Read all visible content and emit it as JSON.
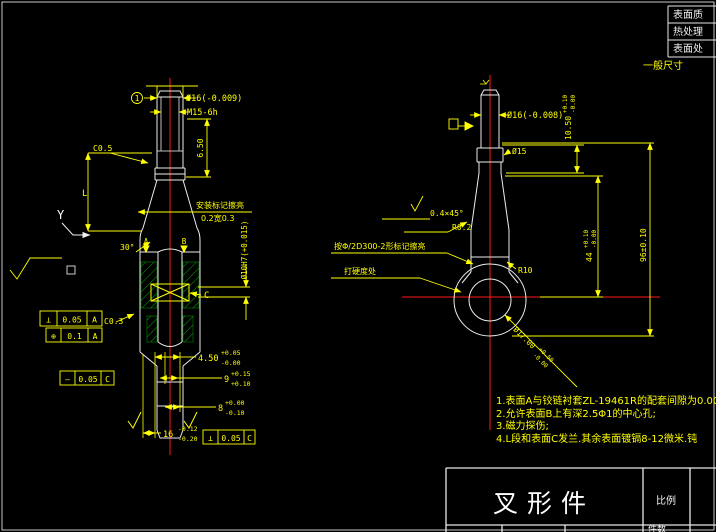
{
  "window": {
    "background": "#000000"
  },
  "colors": {
    "outline": "#f0f0f0",
    "dimension": "#ffff00",
    "centerline": "#ff0000",
    "hatch": "#00a300"
  },
  "info_table": {
    "rows": [
      "表面质",
      "热处理",
      "表面处"
    ]
  },
  "general_note": "一般尺寸",
  "notes": {
    "items": [
      "1.表面A与铰链衬套ZL-19461R的配套间隙为0.00",
      "2.允许表面B上有深2.5Φ1的中心孔;",
      "3.磁力探伤;",
      "4.L段和表面C发兰.其余表面镀镉8-12微米.钝"
    ]
  },
  "title_block": {
    "part_name": "叉形件",
    "scale_label": "比例",
    "qty_label": "件数"
  },
  "left_view": {
    "balloon": "1",
    "dia_label": "Ø16(-0.009)",
    "thread_label": "M15-6h",
    "dim_650": "6.50",
    "chamfer_c05": "C0.5",
    "dim_L": "L",
    "view_y": "Y",
    "leader_mark_line1": "安装标记擦亮",
    "leader_mark_line2": "0.2宽0.3",
    "angle_30": "30°",
    "datum_a": "A",
    "datum_b": "B",
    "datum_c": "C",
    "chamfer_c03": "C0.3",
    "hole_label": "Ø10H7(+0.015)",
    "fcf1": {
      "sym": "⊥",
      "val": "0.05",
      "datum": "A"
    },
    "fcf2": {
      "sym": "⊕",
      "val": "0.1",
      "datum": "A"
    },
    "fcf3": {
      "sym": "—",
      "val": "0.05",
      "datum": "C"
    },
    "fcf4": {
      "sym": "⊥",
      "val": "0.05",
      "datum": "C"
    },
    "dim_450": {
      "v": "4.50",
      "up": "+0.05",
      "dn": "-0.00"
    },
    "dim_9": {
      "v": "9",
      "up": "+0.15",
      "dn": "+0.10"
    },
    "dim_8": {
      "v": "8",
      "up": "+0.00",
      "dn": "-0.10"
    },
    "dim_16": {
      "v": "16",
      "up": "-0.12",
      "dn": "-0.20"
    }
  },
  "right_view": {
    "dia_label": "Ø16(-0.008)",
    "dia_15": "Ø15",
    "dim_1050": {
      "v": "10.50",
      "up": "+0.10",
      "dn": "-0.00"
    },
    "chamfer": "0.4×45°",
    "r02": "R0.2",
    "leader_mark": "按Φ/2D300-2形标记擦亮",
    "hardness": "打硬度处",
    "r10": "R10",
    "dim_44": {
      "v": "44",
      "up": "+0.10",
      "dn": "-0.00"
    },
    "dim_96": "96±0.10",
    "dia_17": {
      "v": "Ø17.00",
      "up": "+0.50",
      "dn": "-0.00"
    }
  }
}
